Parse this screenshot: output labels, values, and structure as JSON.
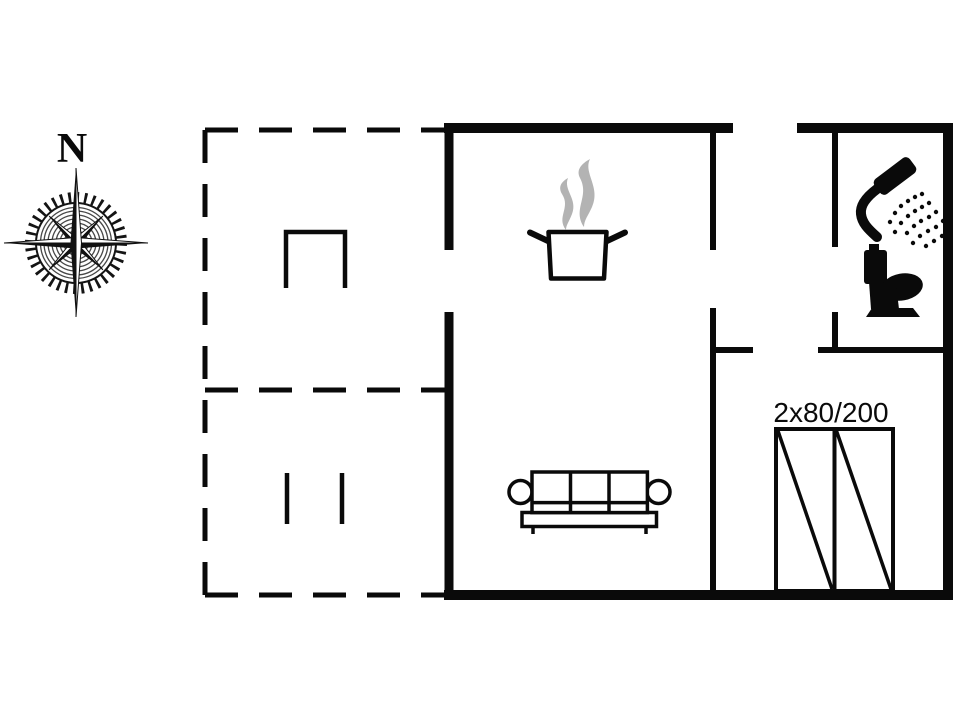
{
  "canvas": {
    "width": 960,
    "height": 720,
    "background_color": "#ffffff",
    "wall_color": "#0a0a0a",
    "steam_color": "#b3b3b3"
  },
  "compass": {
    "north_label": "N",
    "icon": "compass-rose-icon"
  },
  "bedroom": {
    "wardrobe_label": "2x80/200",
    "wardrobe_symbol": "double-wardrobe-symbol"
  },
  "icons": {
    "kitchen": "cooking-pot-icon",
    "kitchen_steam": "steam-icon",
    "living_room": "sofa-icon",
    "bathroom_shower": "shower-icon",
    "bathroom_toilet": "toilet-icon",
    "terrace_upper_furniture": "table-symbol",
    "terrace_lower_furniture": "bench-symbol"
  }
}
